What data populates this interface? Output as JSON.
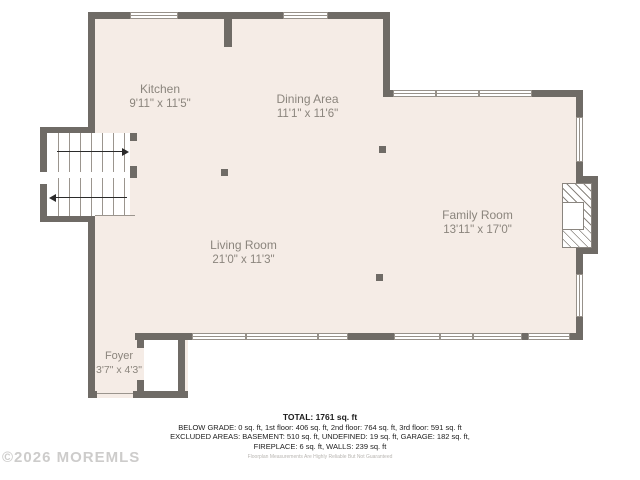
{
  "floorplan": {
    "rooms": [
      {
        "name": "Kitchen",
        "dims": "9'11\" x 11'5\""
      },
      {
        "name": "Dining Area",
        "dims": "11'1\" x 11'6\""
      },
      {
        "name": "Family Room",
        "dims": "13'11\" x 17'0\""
      },
      {
        "name": "Living Room",
        "dims": "21'0\" x 11'3\""
      },
      {
        "name": "Foyer",
        "dims": "3'7\" x 4'3\""
      }
    ],
    "summary": {
      "total": "TOTAL: 1761 sq. ft",
      "line2": "BELOW GRADE: 0 sq. ft, 1st floor: 406 sq. ft, 2nd floor: 764 sq. ft, 3rd floor: 591 sq. ft",
      "line3": "EXCLUDED AREAS: BASEMENT: 510 sq. ft, UNDEFINED: 19 sq. ft, GARAGE: 182 sq. ft,",
      "line4": "FIREPLACE: 6 sq. ft, WALLS: 239 sq. ft",
      "disclaimer": "Floorplan Measurements Are Highly Reliable But Not Guaranteed"
    },
    "watermark": "©2026 MOREMLS",
    "colors": {
      "wall": "#6f6b66",
      "floor": "#f5ece6",
      "label": "#8b857d"
    }
  }
}
